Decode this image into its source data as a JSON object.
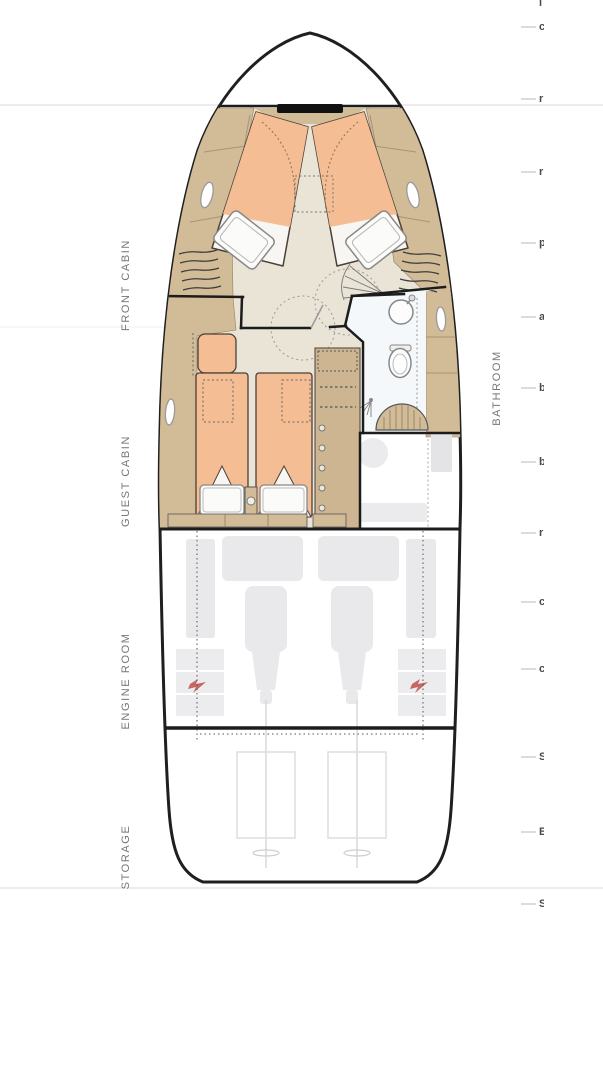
{
  "plan_type": "yacht lower-deck floor plan",
  "labels": {
    "front_cabin": "FRONT CABIN",
    "guest_cabin": "GUEST CABIN",
    "bathroom": "BATHROOM",
    "engine_room": "ENGINE ROOM",
    "storage": "STORAGE"
  },
  "colors": {
    "hull_line": "#1f1f1f",
    "cabinetry_tan": "#d2bb97",
    "floor_beige": "#e9e4d6",
    "mattress_orange": "#f4bd93",
    "bathroom_floor": "#f5f8fa",
    "engine_gray": "#e9e9eb",
    "furniture_light_gray": "#ebebed",
    "label_gray": "#767676",
    "battery_warning_red": "#c0504d"
  },
  "right_edge_marks": [
    {
      "y": 3,
      "char": "l",
      "dash": false
    },
    {
      "y": 27,
      "char": "c",
      "dash": true
    },
    {
      "y": 99,
      "char": "r",
      "dash": true
    },
    {
      "y": 172,
      "char": "r",
      "dash": true
    },
    {
      "y": 243,
      "char": "p",
      "dash": true
    },
    {
      "y": 317,
      "char": "a",
      "dash": true
    },
    {
      "y": 388,
      "char": "b",
      "dash": true
    },
    {
      "y": 462,
      "char": "b",
      "dash": true
    },
    {
      "y": 533,
      "char": "r",
      "dash": true
    },
    {
      "y": 602,
      "char": "c",
      "dash": true
    },
    {
      "y": 669,
      "char": "c",
      "dash": true
    },
    {
      "y": 757,
      "char": "S",
      "dash": true
    },
    {
      "y": 832,
      "char": "E",
      "dash": true
    },
    {
      "y": 904,
      "char": "S",
      "dash": true
    }
  ]
}
